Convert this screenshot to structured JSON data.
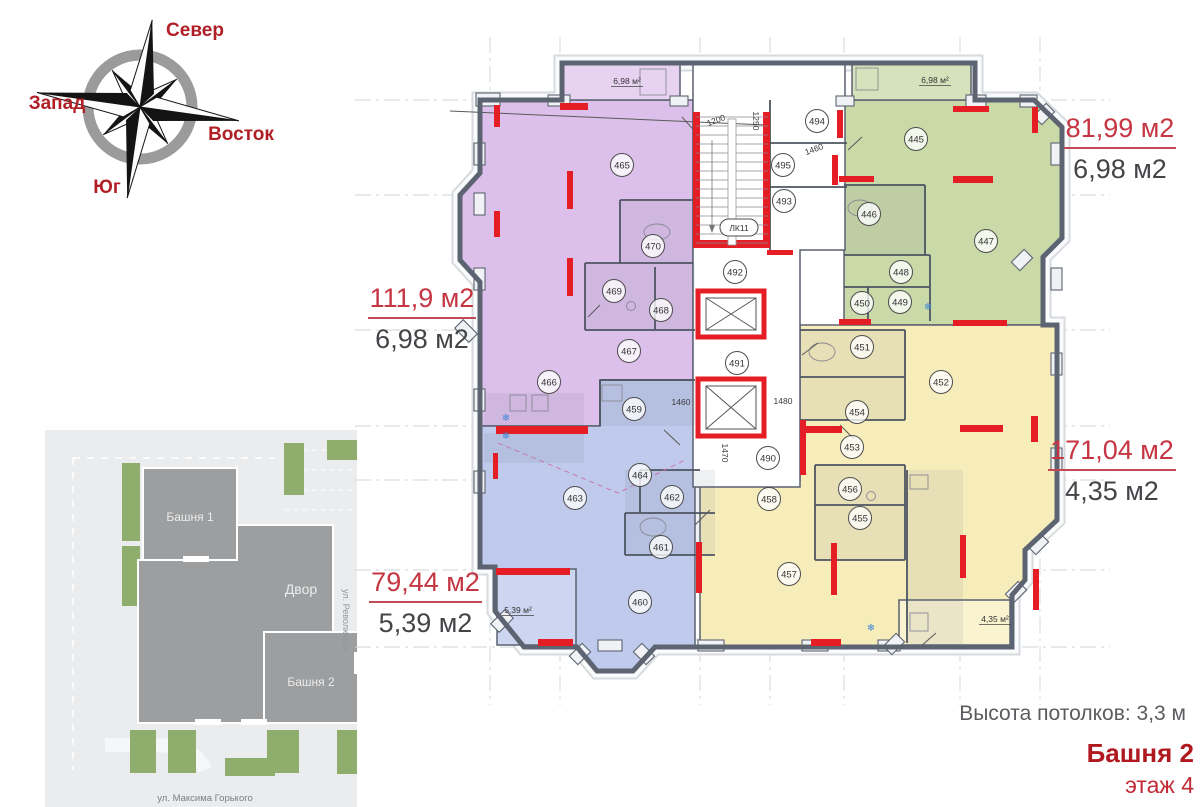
{
  "compass": {
    "north": "Север",
    "west": "Запад",
    "east": "Восток",
    "south": "Юг"
  },
  "site_plan": {
    "tower1": "Башня 1",
    "courtyard": "Двор",
    "tower2": "Башня 2",
    "street_right": "ул. Революции",
    "street_bottom": "ул. Максима Горького"
  },
  "apartments": [
    {
      "key": "green",
      "area": "81,99 м2",
      "balcony": "6,98 м2"
    },
    {
      "key": "purple",
      "area": "111,9 м2",
      "balcony": "6,98 м2"
    },
    {
      "key": "yellow",
      "area": "171,04 м2",
      "balcony": "4,35 м2"
    },
    {
      "key": "blue",
      "area": "79,44 м2",
      "balcony": "5,39 м2"
    }
  ],
  "floor_plan": {
    "stair_label": "ЛК11",
    "rooms": [
      {
        "apt": "purple",
        "label": "465",
        "x": 172,
        "y": 110
      },
      {
        "apt": "purple",
        "label": "466",
        "x": 99,
        "y": 327
      },
      {
        "apt": "purple",
        "label": "467",
        "x": 179,
        "y": 296
      },
      {
        "apt": "purple",
        "label": "468",
        "x": 211,
        "y": 255
      },
      {
        "apt": "purple",
        "label": "469",
        "x": 164,
        "y": 236
      },
      {
        "apt": "purple",
        "label": "470",
        "x": 203,
        "y": 191
      },
      {
        "apt": "green",
        "label": "445",
        "x": 466,
        "y": 84
      },
      {
        "apt": "green",
        "label": "446",
        "x": 419,
        "y": 159
      },
      {
        "apt": "green",
        "label": "447",
        "x": 536,
        "y": 186
      },
      {
        "apt": "green",
        "label": "448",
        "x": 451,
        "y": 217
      },
      {
        "apt": "green",
        "label": "449",
        "x": 450,
        "y": 247
      },
      {
        "apt": "green",
        "label": "450",
        "x": 412,
        "y": 248
      },
      {
        "apt": "yellow",
        "label": "451",
        "x": 412,
        "y": 292
      },
      {
        "apt": "yellow",
        "label": "452",
        "x": 491,
        "y": 327
      },
      {
        "apt": "yellow",
        "label": "453",
        "x": 402,
        "y": 392
      },
      {
        "apt": "yellow",
        "label": "454",
        "x": 407,
        "y": 357
      },
      {
        "apt": "yellow",
        "label": "455",
        "x": 410,
        "y": 463
      },
      {
        "apt": "yellow",
        "label": "456",
        "x": 400,
        "y": 434
      },
      {
        "apt": "yellow",
        "label": "457",
        "x": 339,
        "y": 519
      },
      {
        "apt": "yellow",
        "label": "458",
        "x": 319,
        "y": 444
      },
      {
        "apt": "blue",
        "label": "459",
        "x": 184,
        "y": 354
      },
      {
        "apt": "blue",
        "label": "460",
        "x": 190,
        "y": 547
      },
      {
        "apt": "blue",
        "label": "461",
        "x": 211,
        "y": 492
      },
      {
        "apt": "blue",
        "label": "462",
        "x": 222,
        "y": 442
      },
      {
        "apt": "blue",
        "label": "463",
        "x": 125,
        "y": 443
      },
      {
        "apt": "blue",
        "label": "464",
        "x": 190,
        "y": 420
      },
      {
        "apt": "core",
        "label": "490",
        "x": 318,
        "y": 403
      },
      {
        "apt": "core",
        "label": "491",
        "x": 287,
        "y": 308
      },
      {
        "apt": "core",
        "label": "492",
        "x": 285,
        "y": 217
      },
      {
        "apt": "core",
        "label": "493",
        "x": 334,
        "y": 146
      },
      {
        "apt": "core",
        "label": "494",
        "x": 367,
        "y": 66
      },
      {
        "apt": "core",
        "label": "495",
        "x": 333,
        "y": 110
      }
    ],
    "balcony_labels": [
      {
        "text": "6,98 м²",
        "x": 177,
        "y": 29
      },
      {
        "text": "6,98 м²",
        "x": 485,
        "y": 28
      },
      {
        "text": "5,39 м²",
        "x": 68,
        "y": 558
      },
      {
        "text": "4,35 м²",
        "x": 545,
        "y": 567
      }
    ],
    "dimensions": [
      {
        "text": "1200",
        "x": 267,
        "y": 68,
        "rot": -20
      },
      {
        "text": "1250",
        "x": 303,
        "y": 66,
        "rot": 90
      },
      {
        "text": "1460",
        "x": 365,
        "y": 97,
        "rot": -20
      },
      {
        "text": "1460",
        "x": 231,
        "y": 350,
        "rot": 0
      },
      {
        "text": "1480",
        "x": 333,
        "y": 349,
        "rot": 0
      },
      {
        "text": "1470",
        "x": 272,
        "y": 398,
        "rot": 90
      }
    ]
  },
  "colors": {
    "purple": "#dcc0eb",
    "purple_light": "#e7d2f2",
    "green": "#c9d9a8",
    "green_light": "#d6e2bb",
    "yellow": "#f6edbb",
    "yellow_light": "#faf3cf",
    "blue": "#bfcaec",
    "blue_light": "#cdd6f1",
    "red": "#e51e25",
    "wall": "#5c6472"
  },
  "footer": {
    "ceiling": "Высота потолков: 3,3 м",
    "tower": "Башня 2",
    "floor": "этаж 4"
  }
}
